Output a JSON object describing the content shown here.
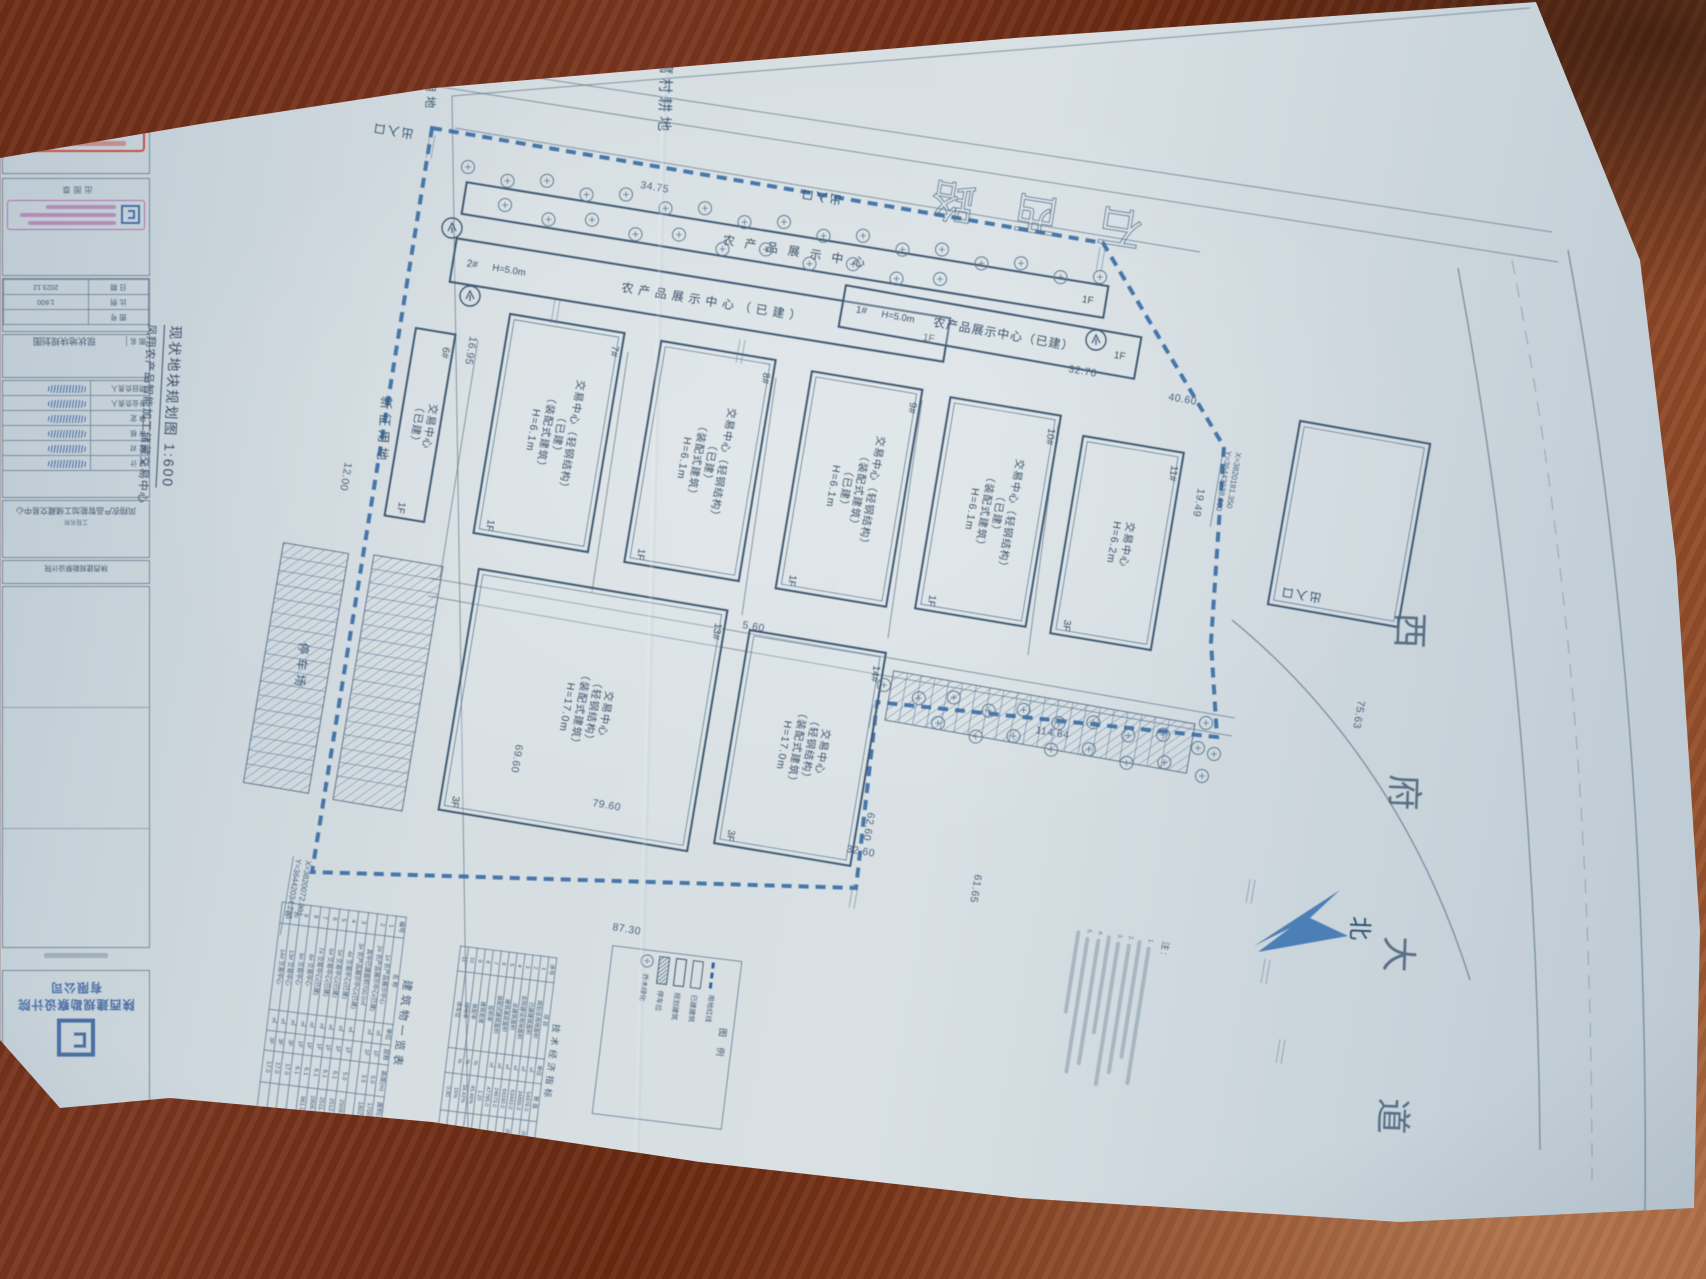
{
  "sheet": {
    "project_name": "凤翔农产品智能加工储藏交易中心",
    "drawing_title": "现状地块规划图",
    "scale": "1:600",
    "drawing_title_full": "现状地块规划图 1:600",
    "date": "2023.12",
    "company_line1": "陕西建规勘察设计院",
    "company_line2": "有限公司",
    "stamps": {
      "registration_no": "611590-001",
      "valid_year": "2025",
      "stamp1_label": "注册章",
      "stamp2_label": "出图章"
    },
    "titleblock": {
      "name_label": "图 名",
      "project_label": "工程名称",
      "info_rows": [
        [
          "图 号",
          ""
        ],
        [
          "比 例",
          "1:600"
        ],
        [
          "日 期",
          "2023.12"
        ]
      ],
      "sign_rows": [
        "设 计",
        "校 对",
        "审 核",
        "审 定",
        "专业负责人",
        "项目负责人"
      ]
    }
  },
  "plan": {
    "road_labels": {
      "top_road": "石 西 路",
      "right_road": "西 府 大 道",
      "north": "北",
      "farmland": "豆腐村耕地",
      "phase2": "二期用地",
      "new_land": "新征用地",
      "parking_lot": "停车场",
      "entrance": "出入口"
    },
    "entrances": [
      {
        "x": 414,
        "y": 130,
        "r": 189
      },
      {
        "x": 842,
        "y": 196,
        "r": 189
      },
      {
        "x": 1322,
        "y": 594,
        "r": 189
      }
    ],
    "area_labels": [
      {
        "t": "豆腐村耕地",
        "x": 662,
        "y": 40,
        "r": 92,
        "s": 15
      },
      {
        "t": "二期用地",
        "x": 428,
        "y": 48,
        "r": 92,
        "s": 12
      },
      {
        "t": "新征用地",
        "x": 382,
        "y": 396,
        "r": 94,
        "s": 13
      },
      {
        "t": "停车场",
        "x": 300,
        "y": 642,
        "r": 96,
        "s": 12
      }
    ],
    "boundary_points": "432,128 1103,243 1224,447 1211,642 1217,737 877,702 856,888 312,872",
    "roads": {
      "lines": [
        [
          0,
          100,
          340,
          48
        ],
        [
          340,
          48,
          1552,
          232
        ],
        [
          0,
          128,
          345,
          72
        ],
        [
          345,
          72,
          1558,
          262
        ],
        [
          455,
          128,
          1200,
          252
        ],
        [
          0,
          62,
          660,
          2
        ],
        [
          430,
          578,
          1235,
          718
        ],
        [
          428,
          596,
          1232,
          736
        ],
        [
          478,
          340,
          440,
          578
        ],
        [
          628,
          352,
          592,
          592
        ],
        [
          776,
          378,
          742,
          615
        ],
        [
          922,
          400,
          888,
          638
        ],
        [
          1058,
          425,
          1028,
          655
        ],
        [
          452,
          96,
          1530,
          8
        ],
        [
          452,
          96,
          468,
          1132
        ]
      ],
      "curves": [
        "M1458,268 C1512,560 1538,860 1540,1150",
        "M1568,250 C1625,560 1648,880 1645,1215",
        "M1232,620 C1330,700 1420,820 1470,980"
      ],
      "center_dash": "M1512,260 C1572,560 1592,870 1592,1180"
    },
    "buildings": [
      {
        "type": "h",
        "num": "",
        "cx": 785,
        "cy": 250,
        "w": 650,
        "h": 32,
        "rot": 9.2,
        "label": "农产品展示中心",
        "hgt": "",
        "fl": "1F",
        "ls": 10
      },
      {
        "type": "h",
        "num": "2#",
        "cx": 700,
        "cy": 300,
        "w": 500,
        "h": 44,
        "rot": 9.2,
        "label": "农产品展示中心（已建）",
        "hgt": "H=5.0m",
        "fl": "1F",
        "ls": 5
      },
      {
        "type": "h",
        "num": "1#",
        "cx": 990,
        "cy": 332,
        "w": 300,
        "h": 42,
        "rot": 10,
        "label": "农产品展示中心（已建）",
        "hgt": "H=5.0m",
        "fl": "1F",
        "ls": 1
      },
      {
        "type": "v",
        "num": "6#",
        "cx": 420,
        "cy": 425,
        "w": 40,
        "h": 190,
        "rot": 9.5,
        "lines": [
          "交易中心",
          "（已建）"
        ],
        "fl": "1F"
      },
      {
        "type": "v",
        "num": "7#",
        "cx": 549,
        "cy": 433,
        "w": 116,
        "h": 222,
        "rot": 9.5,
        "lines": [
          "交易中心（轻钢结构）",
          "（已建）",
          "（装配式建筑）",
          "H=6.1m"
        ],
        "fl": "1F"
      },
      {
        "type": "v",
        "num": "8#",
        "cx": 700,
        "cy": 461,
        "w": 116,
        "h": 224,
        "rot": 9.5,
        "lines": [
          "交易中心（轻钢结构）",
          "（已建）",
          "（装配式建筑）",
          "H=6.1m"
        ],
        "fl": "1F"
      },
      {
        "type": "v",
        "num": "9#",
        "cx": 849,
        "cy": 489,
        "w": 112,
        "h": 220,
        "rot": 9.5,
        "lines": [
          "交易中心（轻钢结构）",
          "（装配式建筑）",
          "（已建）",
          "H=6.1m"
        ],
        "fl": "1F"
      },
      {
        "type": "v",
        "num": "10#",
        "cx": 988,
        "cy": 512,
        "w": 112,
        "h": 214,
        "rot": 9.5,
        "lines": [
          "交易中心（轻钢结构）",
          "（已建）",
          "（装配式建筑）",
          "H=6.1m"
        ],
        "fl": "1F"
      },
      {
        "type": "v",
        "num": "11#",
        "cx": 1117,
        "cy": 543,
        "w": 102,
        "h": 200,
        "rot": 9.5,
        "lines": [
          "交易中心",
          "H=6.2m"
        ],
        "fl": "3F"
      },
      {
        "type": "v",
        "num": "",
        "cx": 1349,
        "cy": 524,
        "w": 132,
        "h": 186,
        "rot": 10,
        "lines": [],
        "fl": ""
      },
      {
        "type": "v",
        "num": "13#",
        "cx": 583,
        "cy": 710,
        "w": 252,
        "h": 244,
        "rot": 9.5,
        "lines": [
          "交易中心",
          "（轻钢结构）",
          "（装配式建筑）",
          "H=17.0m"
        ],
        "fl": "3F"
      },
      {
        "type": "v",
        "num": "14#",
        "cx": 800,
        "cy": 748,
        "w": 138,
        "h": 216,
        "rot": 9.5,
        "lines": [
          "交易中心",
          "（轻钢结构）",
          "（装配式建筑）",
          "H=17.0m"
        ],
        "fl": "3F"
      }
    ],
    "parking": [
      {
        "cx": 296,
        "cy": 668,
        "w": 66,
        "h": 243,
        "rot": 9.5
      },
      {
        "cx": 388,
        "cy": 683,
        "w": 70,
        "h": 248,
        "rot": 9.5
      },
      {
        "cx": 1040,
        "cy": 722,
        "w": 306,
        "h": 50,
        "rot": 10
      }
    ],
    "tree_rows": [
      {
        "x1": 468,
        "y1": 170,
        "x2": 1100,
        "y2": 280,
        "n": 17
      },
      {
        "x1": 505,
        "y1": 208,
        "x2": 940,
        "y2": 282,
        "n": 11
      },
      {
        "x1": 884,
        "y1": 688,
        "x2": 1198,
        "y2": 744,
        "n": 10
      },
      {
        "x1": 938,
        "y1": 726,
        "x2": 1202,
        "y2": 772,
        "n": 8
      },
      {
        "x1": 1206,
        "y1": 726,
        "x2": 1214,
        "y2": 750,
        "n": 2
      }
    ],
    "circled_trees": [
      {
        "x": 452,
        "y": 228
      },
      {
        "x": 470,
        "y": 296
      },
      {
        "x": 1096,
        "y": 340
      }
    ],
    "dimensions": [
      {
        "t": "34.75",
        "x": 640,
        "y": 188,
        "r": 9.5
      },
      {
        "t": "12.00",
        "x": 345,
        "y": 462,
        "r": 99.5
      },
      {
        "t": "87.30",
        "x": 612,
        "y": 930,
        "r": 9.5
      },
      {
        "t": "114.64",
        "x": 1035,
        "y": 733,
        "r": 9.5
      },
      {
        "t": "75.63",
        "x": 1358,
        "y": 700,
        "r": 99.5
      },
      {
        "t": "61.65",
        "x": 975,
        "y": 874,
        "r": 99.5
      },
      {
        "t": "79.60",
        "x": 592,
        "y": 806,
        "r": 9.5
      },
      {
        "t": "69.60",
        "x": 516,
        "y": 744,
        "r": 99.5
      },
      {
        "t": "62.60",
        "x": 868,
        "y": 812,
        "r": 99.5
      },
      {
        "t": "32.60",
        "x": 846,
        "y": 852,
        "r": 9.5
      },
      {
        "t": "40.60",
        "x": 1168,
        "y": 400,
        "r": 9.5
      },
      {
        "t": "19.49",
        "x": 1198,
        "y": 488,
        "r": 99.5
      },
      {
        "t": "5.60",
        "x": 742,
        "y": 628,
        "r": 9.5
      },
      {
        "t": "16.95",
        "x": 470,
        "y": 336,
        "r": 99.5
      },
      {
        "t": "32.70",
        "x": 1068,
        "y": 372,
        "r": 9.5
      }
    ],
    "coords": [
      {
        "x": 306,
        "y": 860,
        "r": 99.5,
        "l1": "X=3820072.801",
        "l2": "Y=36442034.235"
      },
      {
        "x": 1236,
        "y": 452,
        "r": 99.5,
        "l1": "X=3820181.350",
        "l2": "Y=36443978.600"
      }
    ],
    "coord_ticks": [
      {
        "x": 435,
        "y": 135,
        "r": 99.5
      },
      {
        "x": 1105,
        "y": 248,
        "r": 99.5
      },
      {
        "x": 878,
        "y": 705,
        "r": 99.5
      },
      {
        "x": 858,
        "y": 885,
        "r": 99.5
      },
      {
        "x": 560,
        "y": 300,
        "r": 99.5
      },
      {
        "x": 745,
        "y": 340,
        "r": 99.5
      },
      {
        "x": 1255,
        "y": 880,
        "r": 99.5
      },
      {
        "x": 1270,
        "y": 960,
        "r": 99.5
      },
      {
        "x": 1285,
        "y": 1040,
        "r": 99.5
      }
    ],
    "north_arrow": "M1254,946 L1340,890 L1310,918 L1348,936 L1258,952 L1290,928 Z"
  },
  "tables": {
    "buildings_list": {
      "title": "建筑物一览表",
      "columns": [
        "编号",
        "名  称",
        "单位",
        "层数",
        "高度(m)",
        "面积(㎡)"
      ],
      "rows": [
        [
          "1",
          "1# 农产品展示中心",
          "㎡",
          "1F",
          "5.0",
          "1709.0"
        ],
        [
          "2",
          "2# 农产品展示中心(已建)",
          "㎡",
          "1F",
          "3.5",
          "1802.0"
        ],
        [
          "",
          "其中已建面积700.0㎡",
          "",
          "",
          "",
          ""
        ],
        [
          "3",
          "3# 农产品展示中心(已建)",
          "㎡",
          "1F",
          "5.0",
          "2509.0"
        ],
        [
          "4",
          "4# 交易中心(已建)",
          "㎡",
          "1F",
          "6.1",
          "2512.0"
        ],
        [
          "5",
          "5# 交易中心(已建)",
          "㎡",
          "1F",
          "6.1",
          "2511.0"
        ],
        [
          "6",
          "6# 交易中心(已建)",
          "㎡",
          "1F",
          "6.1",
          "2806.0"
        ],
        [
          "7",
          "7# 交易中心(已建)",
          "㎡",
          "1F",
          "6.1",
          "961.0"
        ],
        [
          "8",
          "8# 交易中心",
          "㎡",
          "1F",
          "6.1",
          ""
        ],
        [
          "9",
          "9# 交易中心",
          "㎡",
          "3F",
          "17.0",
          ""
        ],
        [
          "10",
          "13# 交易中心",
          "㎡",
          "3F",
          "17.0",
          ""
        ],
        [
          "11",
          "14# 交易中心",
          "㎡",
          "3F",
          "17.0",
          ""
        ]
      ]
    },
    "indicators": {
      "title": "技术经济指标",
      "columns": [
        "序号",
        "项  目",
        "单位",
        "数 值",
        "备 注"
      ],
      "rows": [
        [
          "1",
          "规划总用地面积",
          "㎡",
          "54976.0",
          "(82.46亩)"
        ],
        [
          "2",
          "已建建筑面积",
          "㎡",
          "34855.0",
          ""
        ],
        [
          "3",
          "实际建设用地面积",
          "㎡",
          "53443.0",
          "(80.16亩)"
        ],
        [
          "4",
          "总建筑面积",
          "㎡",
          "64190.0",
          ""
        ],
        [
          "5",
          "建筑基底面积",
          "㎡",
          "24673.0",
          ""
        ],
        [
          "6",
          "装配式建筑面积",
          "㎡",
          "47785.0",
          ""
        ],
        [
          "7",
          "容积率",
          "",
          "1.20",
          ""
        ],
        [
          "8",
          "建筑密度",
          "%",
          "45.46%",
          ""
        ],
        [
          "9",
          "装配率",
          "%",
          "34.42%",
          ""
        ],
        [
          "10",
          "绿地率",
          "%",
          "15%",
          ""
        ],
        [
          "11",
          "停车位",
          "",
          "0.80",
          ""
        ]
      ]
    },
    "legend": {
      "title": "图  例",
      "items": [
        {
          "sym": "boundary",
          "label": "用地红线"
        },
        {
          "sym": "built",
          "label": "已建建筑"
        },
        {
          "sym": "planned",
          "label": "规划建筑"
        },
        {
          "sym": "parking",
          "label": "停车位"
        },
        {
          "sym": "tree",
          "label": "乔木绿化"
        }
      ]
    },
    "notes_label": "注:"
  }
}
